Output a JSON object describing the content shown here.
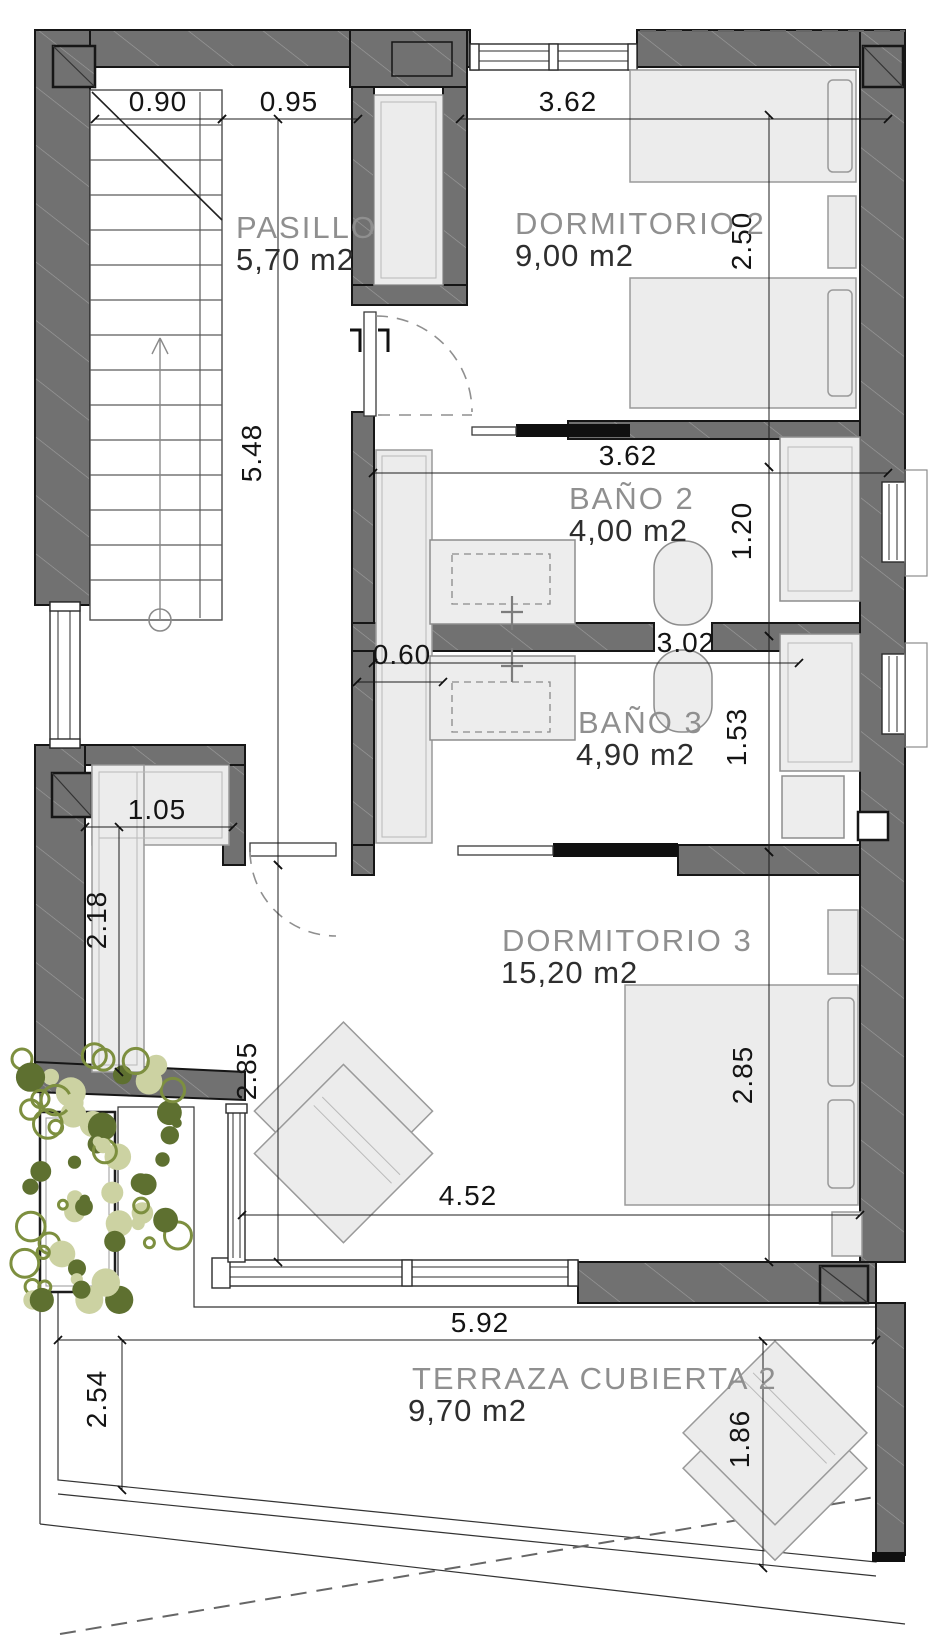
{
  "rooms": {
    "pasillo": {
      "name": "PASILLO",
      "area": "5,70 m2"
    },
    "dormitorio2": {
      "name": "DORMITORIO 2",
      "area": "9,00 m2"
    },
    "bano2": {
      "name": "BAÑO 2",
      "area": "4,00 m2"
    },
    "bano3": {
      "name": "BAÑO 3",
      "area": "4,90 m2"
    },
    "dormitorio3": {
      "name": "DORMITORIO 3",
      "area": "15,20 m2"
    },
    "terraza": {
      "name": "TERRAZA CUBIERTA 2",
      "area": "9,70 m2"
    }
  },
  "dimensions": {
    "w090": {
      "value": "0.90"
    },
    "w095": {
      "value": "0.95"
    },
    "w362_dorm2": {
      "value": "3.62"
    },
    "h250": {
      "value": "2.50"
    },
    "h548": {
      "value": "5.48"
    },
    "w362_bano2": {
      "value": "3.62"
    },
    "h120": {
      "value": "1.20"
    },
    "w060": {
      "value": "0.60"
    },
    "w302": {
      "value": "3.02"
    },
    "h153": {
      "value": "1.53"
    },
    "w105": {
      "value": "1.05"
    },
    "h218": {
      "value": "2.18"
    },
    "h285_left": {
      "value": "2.85"
    },
    "h285_right": {
      "value": "2.85"
    },
    "w452": {
      "value": "4.52"
    },
    "w592": {
      "value": "5.92"
    },
    "h254": {
      "value": "2.54"
    },
    "h186": {
      "value": "1.86"
    }
  },
  "colors": {
    "wall": "#717171",
    "tile": "#f9b29e",
    "furniture": "#ececec",
    "furniture_edge": "#9a9a9a",
    "room_label": "#8f8f8f",
    "area_text": "#2e2e2e",
    "dim_text": "#141414",
    "plant_olive": "#7d8f3f",
    "plant_sage": "#ccd2a2",
    "plant_dark": "#5e7030"
  }
}
